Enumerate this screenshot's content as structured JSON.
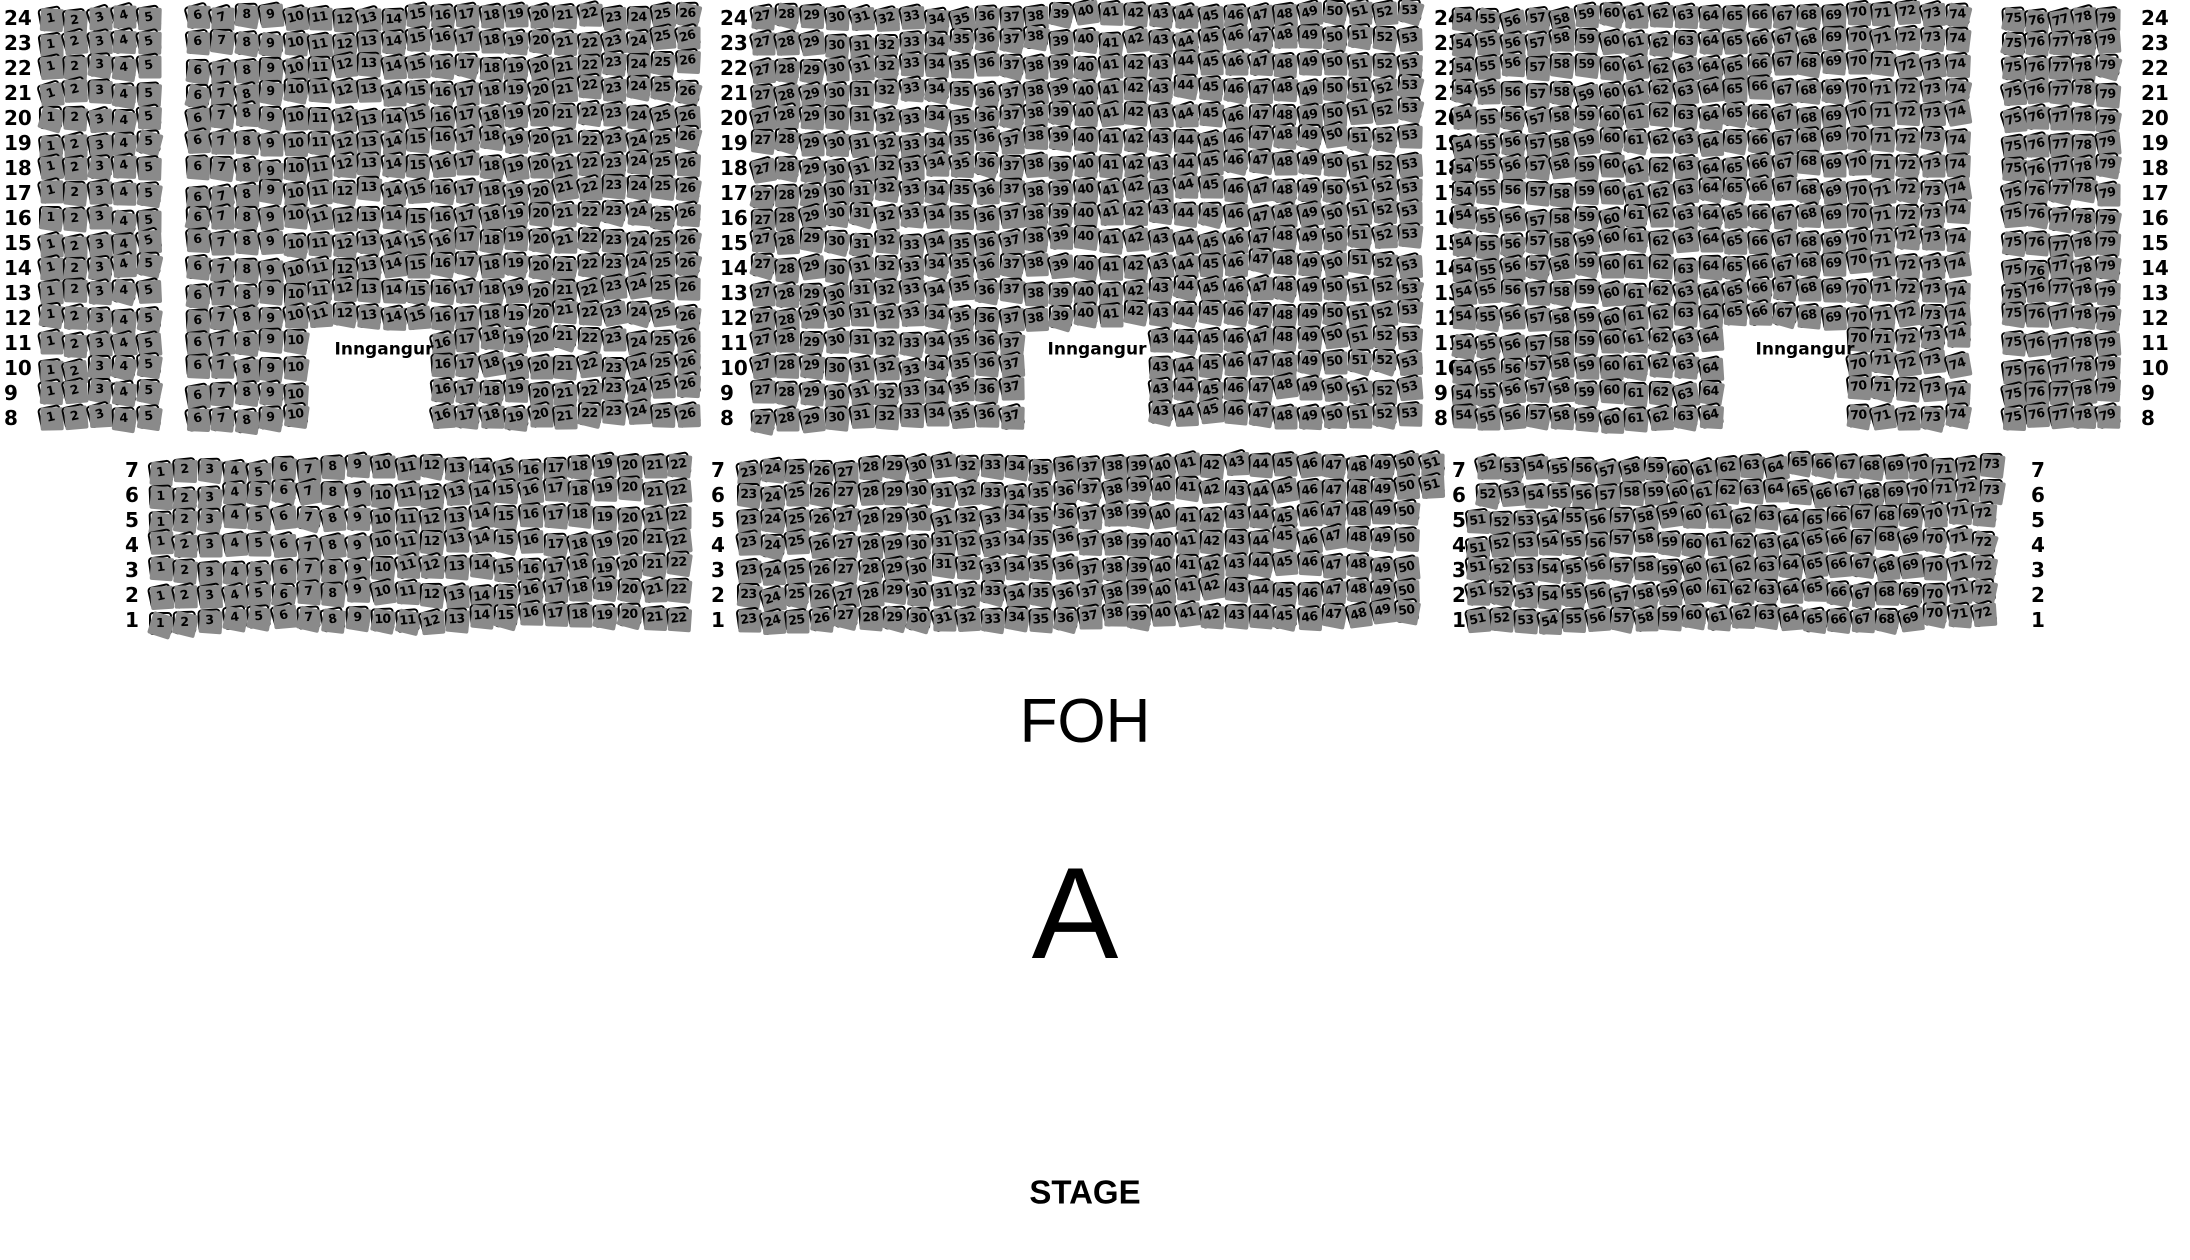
{
  "venue_map": {
    "section_label": "A",
    "foh_label": "FOH",
    "stage_label": "STAGE",
    "entrance_label": "Inngangur"
  },
  "colors": {
    "background": "#ffffff",
    "seat_fill": "#ffffff",
    "seat_border": "#000000",
    "seat_shadow": "#8a8a8a",
    "text": "#000000"
  },
  "top_section": {
    "row_labels": [
      "24",
      "23",
      "22",
      "21",
      "20",
      "19",
      "18",
      "17",
      "16",
      "15",
      "14",
      "13",
      "12",
      "11",
      "10",
      "9",
      "8"
    ],
    "label_columns_x": [
      4,
      720,
      1434,
      2141
    ],
    "row_y_start": 18,
    "row_pitch": 25,
    "entrance_gap_rows": [
      "11",
      "10",
      "9",
      "8"
    ],
    "blocks": [
      {
        "seat_start": 1,
        "seat_end": 5,
        "x": 50,
        "pitch": 24.5
      },
      {
        "seat_start": 6,
        "seat_end": 26,
        "x": 197,
        "pitch": 24.5,
        "gap_start": 11,
        "gap_end": 15
      },
      {
        "seat_start": 27,
        "seat_end": 53,
        "x": 762,
        "pitch": 24.9,
        "gap_start": 38,
        "gap_end": 42
      },
      {
        "seat_start": 54,
        "seat_end": 74,
        "x": 1463,
        "pitch": 24.7,
        "gap_start": 65,
        "gap_end": 69
      },
      {
        "seat_start": 75,
        "seat_end": 79,
        "x": 2013,
        "pitch": 23.5
      }
    ],
    "entrance_label_positions": [
      {
        "x": 384,
        "y": 350
      },
      {
        "x": 1097,
        "y": 350
      },
      {
        "x": 1805,
        "y": 350
      }
    ]
  },
  "bottom_section": {
    "row_labels": [
      "7",
      "6",
      "5",
      "4",
      "3",
      "2",
      "1"
    ],
    "label_columns_x": [
      125,
      711,
      1452,
      2031
    ],
    "row_y_start": 470,
    "row_pitch": 25,
    "row_groups": [
      {
        "rows": [
          "7",
          "6"
        ],
        "blocks": [
          {
            "seat_start": 1,
            "seat_end": 22,
            "x": 160,
            "pitch": 24.7
          },
          {
            "seat_start": 23,
            "seat_end": 51,
            "x": 748,
            "pitch": 24.4
          },
          {
            "seat_start": 52,
            "seat_end": 73,
            "x": 1487,
            "pitch": 24.0
          }
        ]
      },
      {
        "rows": [
          "5",
          "4",
          "3",
          "2",
          "1"
        ],
        "blocks": [
          {
            "seat_start": 1,
            "seat_end": 22,
            "x": 160,
            "pitch": 24.7
          },
          {
            "seat_start": 23,
            "seat_end": 50,
            "x": 748,
            "pitch": 24.4
          },
          {
            "seat_start": 51,
            "seat_end": 72,
            "x": 1477,
            "pitch": 24.1
          }
        ]
      }
    ]
  },
  "foh_position": {
    "x": 1085,
    "y": 722
  },
  "section_letter_position": {
    "x": 1075,
    "y": 913
  },
  "stage_position": {
    "x": 1085,
    "y": 1192
  }
}
